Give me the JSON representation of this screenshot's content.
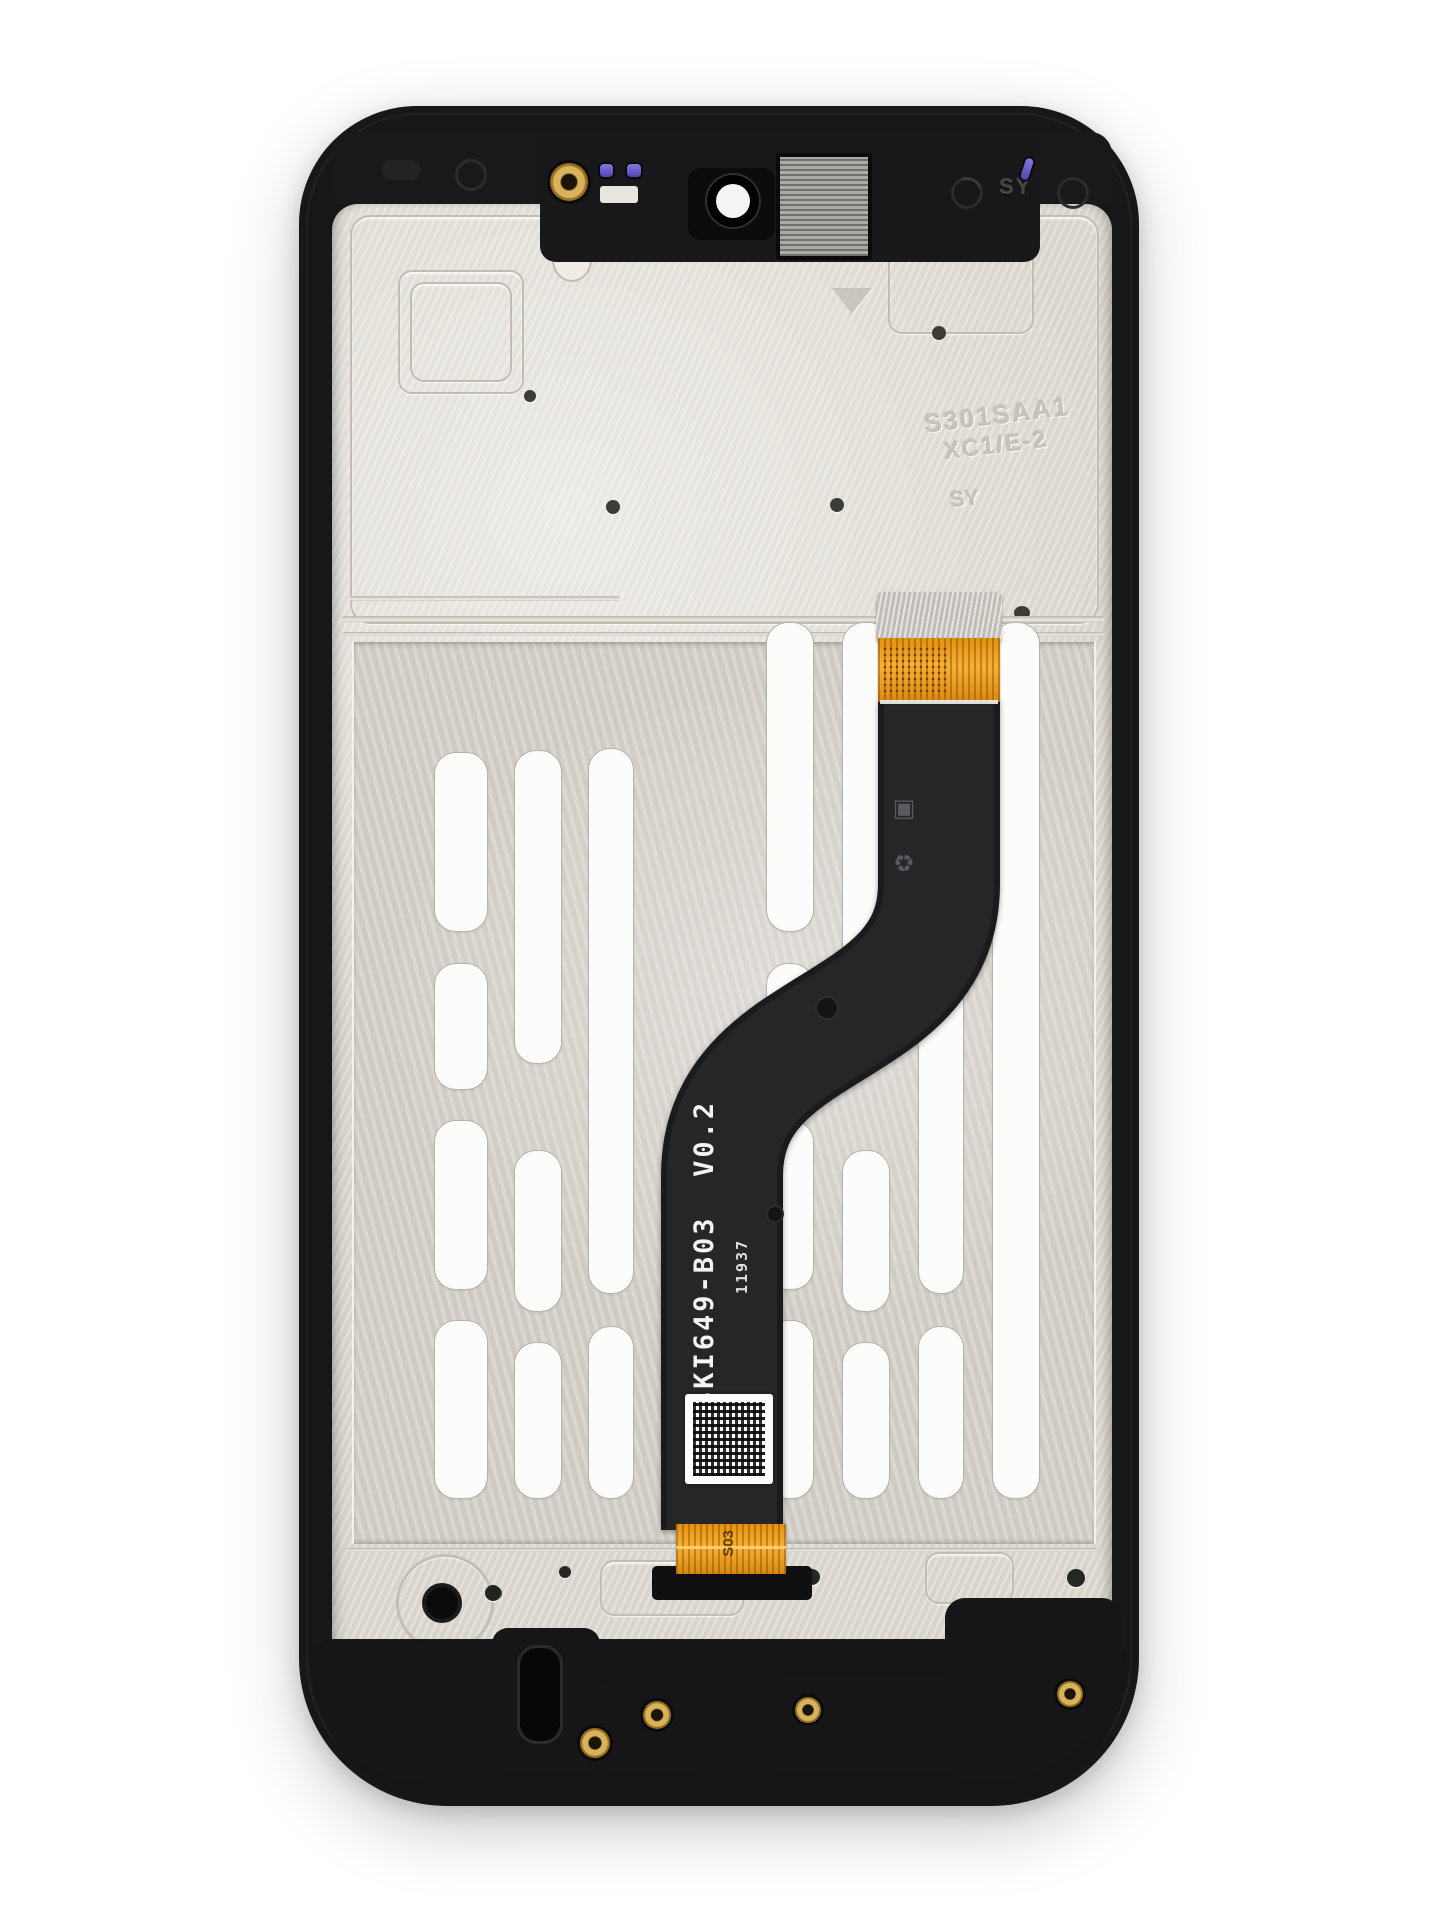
{
  "photo": {
    "subject": "smartphone LCD screen assembly with frame, rear view, attached flex cable",
    "background": "#ffffff"
  },
  "labels": {
    "flex_model": "SKI649-B03  V0.2",
    "flex_date_code": "11937",
    "frame_engraving": "SY-A20S",
    "casting_line1": "S301SAA1",
    "casting_line2": "XC1/E-2",
    "casting_initials": "SY",
    "bezel_initials": "SY",
    "connector_mark": "S03",
    "recycle_marks": "♻ ▣"
  },
  "colors": {
    "frame_black": "#17171a",
    "metal_plate": "#dcd8d0",
    "display_back": "#d4d0c9",
    "adhesive_strip": "#fcfcfb",
    "flex_black": "#1b1b1e",
    "flex_orange": "#f0a024",
    "brass_grommet": "#d9b25c",
    "sensor_purple": "#7a6fd8",
    "qr_label": "#fdfdfd",
    "camera_ring_white": "#f4f4f2"
  }
}
